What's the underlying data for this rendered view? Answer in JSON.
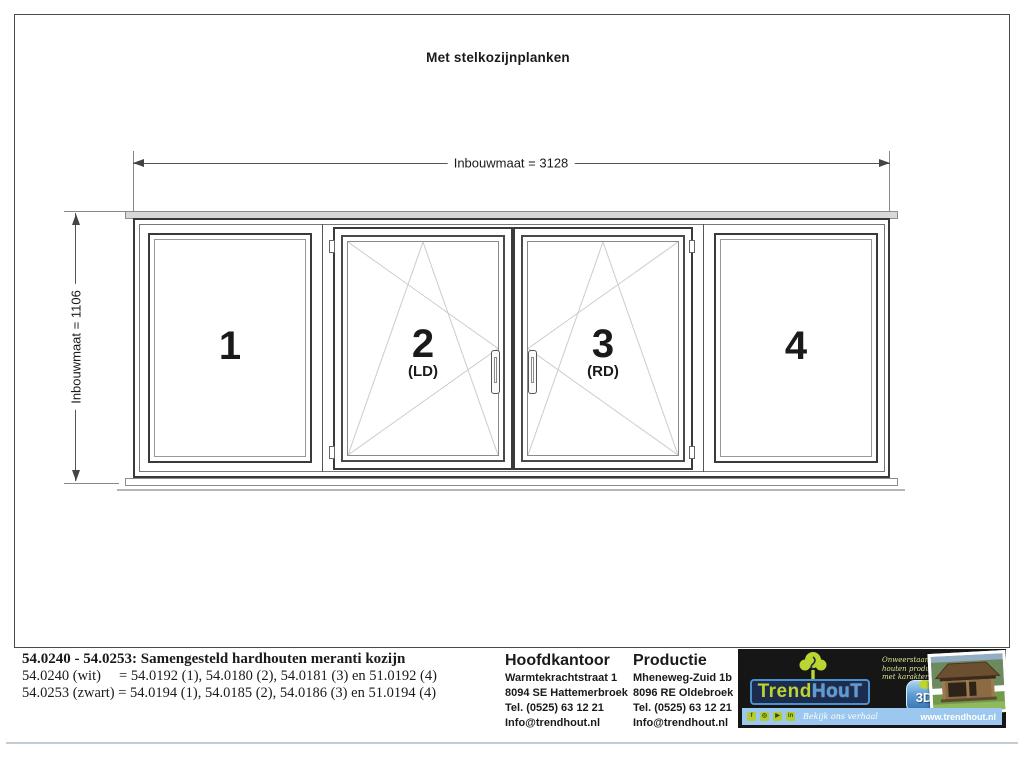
{
  "title": "Met stelkozijnplanken",
  "dimensions": {
    "width_label": "Inbouwmaat = 3128",
    "height_label": "Inbouwmaat = 1106"
  },
  "windows": [
    {
      "number": "1",
      "sub": ""
    },
    {
      "number": "2",
      "sub": "(LD)"
    },
    {
      "number": "3",
      "sub": "(RD)"
    },
    {
      "number": "4",
      "sub": ""
    }
  ],
  "spec": {
    "title": "54.0240 - 54.0253: Samengesteld hardhouten meranti kozijn",
    "line_wit": "54.0240 (wit)     = 54.0192 (1), 54.0180 (2), 54.0181 (3) en 51.0192 (4)",
    "line_zwart": "54.0253 (zwart) = 54.0194 (1), 54.0185 (2), 54.0186 (3) en 51.0194 (4)"
  },
  "hoofdkantoor": {
    "header": "Hoofdkantoor",
    "lines": [
      "Warmtekrachtstraat 1",
      "8094 SE Hattemerbroek",
      "Tel. (0525) 63 12 21",
      "Info@trendhout.nl"
    ]
  },
  "productie": {
    "header": "Productie",
    "lines": [
      "Mheneweg-Zuid 1b",
      "8096 RE Oldebroek",
      "Tel. (0525) 63 12 21",
      "Info@trendhout.nl"
    ]
  },
  "logo": {
    "brand_trend": "Trend",
    "brand_hout": "HouT",
    "tagline_lines": [
      "Onweerstaanbare",
      "houten producten",
      "met karakter"
    ],
    "badge_3d": "3D",
    "social_text": "Bekijk ons verhaal",
    "website": "www.trendhout.nl",
    "colors": {
      "green": "#bcd631",
      "blue": "#4e8fce",
      "bar_blue": "#9cc7ee",
      "box_black": "#161616"
    }
  }
}
